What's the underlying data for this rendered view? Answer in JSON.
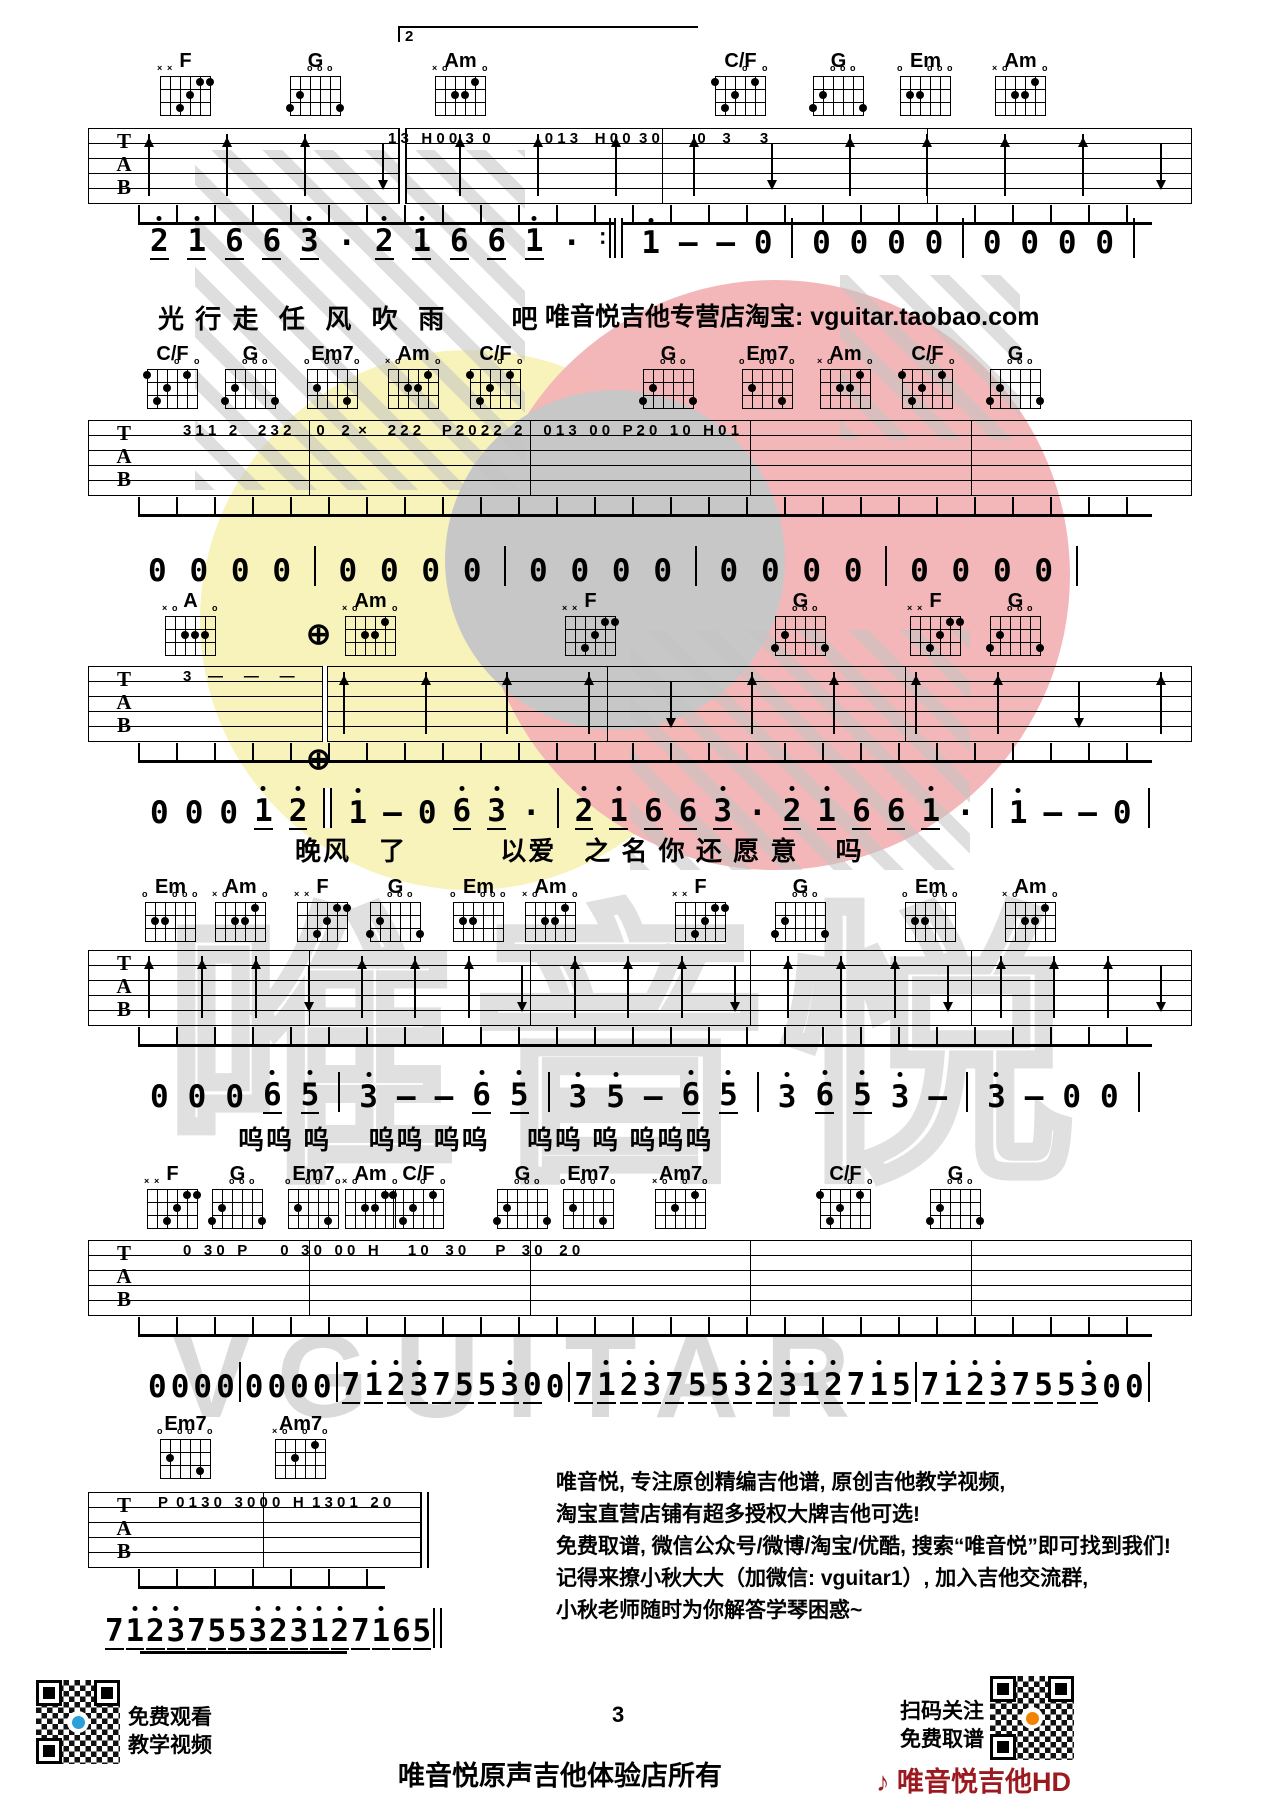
{
  "page_number": "3",
  "store_line": "唯音悦吉他专营店淘宝: vguitar.taobao.com",
  "footer_owner": "唯音悦原声吉他体验店所有",
  "brand_red": "♪ 唯音悦吉他HD",
  "qr_left": [
    "免费观看",
    "教学视频"
  ],
  "qr_right": [
    "扫码关注",
    "免费取谱"
  ],
  "promo": [
    "唯音悦, 专注原创精编吉他谱, 原创吉他教学视频,",
    "淘宝直营店铺有超多授权大牌吉他可选!",
    "免费取谱, 微信公众号/微博/淘宝/优酷, 搜索“唯音悦”即可找到我们!",
    "记得来撩小秋大大（加微信: vguitar1）, 加入吉他交流群,",
    "小秋老师随时为你解答学琴困惑~"
  ],
  "watermark": {
    "text_cn": "唯音悦",
    "text_en": "VGUITAR",
    "yellow": "#f7f3bb",
    "red": "#f3b3b5",
    "gray": "#c7c7c7"
  },
  "chord_shapes": {
    "F": {
      "m": [
        "x",
        "x",
        "",
        "",
        "",
        ""
      ],
      "d": [
        [
          4,
          3
        ],
        [
          3,
          2
        ],
        [
          2,
          1
        ],
        [
          1,
          1
        ]
      ]
    },
    "G": {
      "m": [
        "",
        "",
        "o",
        "o",
        "o",
        ""
      ],
      "d": [
        [
          6,
          3
        ],
        [
          5,
          2
        ],
        [
          1,
          3
        ]
      ]
    },
    "Am": {
      "m": [
        "x",
        "o",
        "",
        "",
        "",
        "o"
      ],
      "d": [
        [
          2,
          1
        ],
        [
          4,
          2
        ],
        [
          3,
          2
        ]
      ]
    },
    "C/F": {
      "m": [
        "",
        "",
        "",
        "o",
        "",
        "o"
      ],
      "d": [
        [
          6,
          1
        ],
        [
          2,
          1
        ],
        [
          4,
          2
        ],
        [
          5,
          3
        ]
      ]
    },
    "Em": {
      "m": [
        "o",
        "",
        "",
        "o",
        "o",
        "o"
      ],
      "d": [
        [
          5,
          2
        ],
        [
          4,
          2
        ]
      ]
    },
    "Em7": {
      "m": [
        "o",
        "",
        "o",
        "o",
        "",
        "o"
      ],
      "d": [
        [
          5,
          2
        ],
        [
          2,
          3
        ]
      ]
    },
    "Am7": {
      "m": [
        "x",
        "o",
        "",
        "o",
        "",
        "o"
      ],
      "d": [
        [
          4,
          2
        ],
        [
          2,
          1
        ]
      ]
    },
    "A": {
      "m": [
        "x",
        "o",
        "",
        "",
        "",
        "o"
      ],
      "d": [
        [
          4,
          2
        ],
        [
          3,
          2
        ],
        [
          2,
          2
        ]
      ]
    }
  },
  "systems": [
    {
      "cy": 50,
      "chords": [
        {
          "n": "F",
          "x": 185
        },
        {
          "n": "G",
          "x": 315
        },
        {
          "n": "Am",
          "x": 460
        },
        {
          "n": "C/F",
          "x": 740
        },
        {
          "n": "G",
          "x": 838
        },
        {
          "n": "Em",
          "x": 925
        },
        {
          "n": "Am",
          "x": 1020
        }
      ],
      "staff": {
        "x1": 88,
        "x2": 1192,
        "y": 128,
        "fracs": [
          0.281,
          0.52,
          0.76
        ],
        "rep0": "thick",
        "ann": "1 3   H 0 0  3  0             0 1 3    H 0 0  3 0         0    3       3",
        "annx": 300,
        "strums": "uuuduuuuduuuud",
        "strum_l": 60,
        "strum_r": 30
      },
      "volta": {
        "x": 398,
        "y": 26,
        "w": 298,
        "label": "2"
      },
      "numbers": {
        "y": 218,
        "x1": 150,
        "x2": 1135,
        "toks": [
          "'_2",
          "'_1",
          "_6",
          "_6",
          "'_3",
          "·",
          "'_2",
          "'_1",
          "_6",
          "_6",
          "'_1",
          "·",
          ":‖",
          "'1",
          "—",
          "—",
          "0",
          "|",
          "0",
          "0",
          "0",
          "0",
          "|",
          "0",
          "0",
          "0",
          "0",
          "|"
        ]
      },
      "lyrics": {
        "x": 158,
        "y": 299,
        "text": "光 行 走  任  风  吹  雨　　 吧"
      }
    },
    {
      "cy": 343,
      "chords": [
        {
          "n": "C/F",
          "x": 172
        },
        {
          "n": "G",
          "x": 250
        },
        {
          "n": "Em7",
          "x": 332
        },
        {
          "n": "Am",
          "x": 413
        },
        {
          "n": "C/F",
          "x": 495
        },
        {
          "n": "G",
          "x": 668
        },
        {
          "n": "Em7",
          "x": 767
        },
        {
          "n": "Am",
          "x": 845
        },
        {
          "n": "C/F",
          "x": 927
        },
        {
          "n": "G",
          "x": 1015
        }
      ],
      "staff": {
        "x1": 88,
        "x2": 1192,
        "y": 420,
        "fracs": [
          0.2,
          0.4,
          0.6,
          0.8
        ],
        "ann": "3 1 1   2     2 3 2      0    2  ×     2 2 2     P 2 0 2 2   2     0 1 3   0 0   P 2 0   1 0   H 0 1",
        "annx": 95,
        "strums": ""
      },
      "numbers": {
        "y": 546,
        "x1": 148,
        "x2": 1078,
        "toks": [
          "0",
          "0",
          "0",
          "0",
          "|",
          "0",
          "0",
          "0",
          "0",
          "|",
          "0",
          "0",
          "0",
          "0",
          "|",
          "0",
          "0",
          "0",
          "0",
          "|",
          "0",
          "0",
          "0",
          "0",
          "|"
        ]
      }
    },
    {
      "cy": 590,
      "chords": [
        {
          "n": "A",
          "x": 190
        },
        {
          "n": "Am",
          "x": 370
        },
        {
          "n": "F",
          "x": 590
        },
        {
          "n": "G",
          "x": 800
        },
        {
          "n": "F",
          "x": 935
        },
        {
          "n": "G",
          "x": 1015
        }
      ],
      "staff": {
        "x1": 88,
        "x2": 1192,
        "y": 666,
        "fracs": [
          0.212,
          0.47,
          0.74
        ],
        "rep0": "dbl",
        "ann": "3    —     —     —",
        "annx": 95,
        "strums": "uuuuduuuudu",
        "strum_l": 255,
        "strum_r": 30
      },
      "marks": [
        {
          "t": "⊕",
          "x": 306,
          "y": 620
        },
        {
          "t": "⊕",
          "x": 306,
          "y": 745
        }
      ],
      "numbers": {
        "y": 788,
        "x1": 150,
        "x2": 1150,
        "toks": [
          "0",
          "0",
          "0",
          "'_1",
          "'_2",
          "‖",
          "'1",
          "—",
          "0",
          "'_6",
          "'_3",
          "·",
          "|",
          "'_2",
          "'_1",
          "_6",
          "_6",
          "'_3",
          "·",
          "'_2",
          "'_1",
          "_6",
          "_6",
          "'_1",
          "·",
          "|",
          "'1",
          "—",
          "—",
          "0",
          "|"
        ]
      },
      "lyrics": {
        "x": 295,
        "y": 831,
        "text": "晚风　了　　　 以爱　之 名 你 还 愿 意　 吗"
      }
    },
    {
      "cy": 876,
      "chords": [
        {
          "n": "Em",
          "x": 170
        },
        {
          "n": "Am",
          "x": 240
        },
        {
          "n": "F",
          "x": 322
        },
        {
          "n": "G",
          "x": 395
        },
        {
          "n": "Em",
          "x": 478
        },
        {
          "n": "Am",
          "x": 550
        },
        {
          "n": "F",
          "x": 700
        },
        {
          "n": "G",
          "x": 800
        },
        {
          "n": "Em",
          "x": 930
        },
        {
          "n": "Am",
          "x": 1030
        }
      ],
      "staff": {
        "x1": 88,
        "x2": 1192,
        "y": 950,
        "fracs": [
          0.2,
          0.4,
          0.6,
          0.8
        ],
        "ann": "",
        "annx": 95,
        "strums": "uuuduuuduuuduuuduuud",
        "strum_l": 60,
        "strum_r": 30
      },
      "numbers": {
        "y": 1072,
        "x1": 150,
        "x2": 1140,
        "toks": [
          "0",
          "0",
          "0",
          "'_6",
          "'_5",
          "|",
          "'3",
          "—",
          "—",
          "'_6",
          "'_5",
          "|",
          "'3",
          "'5",
          "—",
          "'_6",
          "'_5",
          "|",
          "'3",
          "'_6",
          "'_5",
          "'3",
          "—",
          "|",
          "'3",
          "—",
          "0",
          "0",
          "|"
        ]
      },
      "lyrics": {
        "x": 238,
        "y": 1120,
        "text": "呜呜 呜　 呜呜 呜呜　 呜呜 呜 呜呜呜"
      }
    },
    {
      "cy": 1163,
      "chords": [
        {
          "n": "F",
          "x": 172
        },
        {
          "n": "G",
          "x": 237
        },
        {
          "n": "Em7",
          "x": 313
        },
        {
          "n": "Am",
          "x": 370
        },
        {
          "n": "C/F",
          "x": 418
        },
        {
          "n": "G",
          "x": 522
        },
        {
          "n": "Em7",
          "x": 588
        },
        {
          "n": "Am7",
          "x": 680
        },
        {
          "n": "C/F",
          "x": 845
        },
        {
          "n": "G",
          "x": 955
        }
      ],
      "staff": {
        "x1": 88,
        "x2": 1192,
        "y": 1240,
        "fracs": [
          0.2,
          0.4,
          0.6,
          0.8
        ],
        "ann": "0   3 0   P        0   3 0   0 0   H       1 0    3 0       P    3 0    2 0",
        "annx": 95,
        "strums": ""
      },
      "numbers": {
        "y": 1362,
        "x1": 148,
        "x2": 1150,
        "toks": [
          "0",
          "0",
          "0",
          "0",
          "|",
          "0",
          "0",
          "0",
          "0",
          "|",
          "_7",
          "'_1",
          "'_2",
          "'_3",
          "_7",
          "_5",
          "_5",
          "'_3",
          "_0",
          "0",
          "|",
          "_7",
          "'_1",
          "'_2",
          "'_3",
          "_7",
          "_5",
          "_5",
          "'_3",
          "'_2",
          "'_3",
          "'_1",
          "'_2",
          "_7",
          "'_1",
          "_5",
          "|",
          "_7",
          "'_1",
          "'_2",
          "'_3",
          "_7",
          "_5",
          "_5",
          "'_3",
          "0",
          "0",
          "|"
        ]
      }
    },
    {
      "cy": 1413,
      "chords": [
        {
          "n": "Em7",
          "x": 185
        },
        {
          "n": "Am7",
          "x": 300
        }
      ],
      "staff": {
        "x1": 88,
        "x2": 425,
        "y": 1492,
        "fracs": [
          0.52
        ],
        "end": "thick",
        "ann": "P  0 1 3 0   3 0 0 0   H  1 3 0 1   2 0",
        "annx": 70,
        "strums": ""
      },
      "rules": [
        {
          "x": 140,
          "y": 1651,
          "w": 207,
          "h": 3
        }
      ],
      "numbers": {
        "y": 1608,
        "x1": 105,
        "x2": 442,
        "toks": [
          "_7",
          "'_1",
          "'_2",
          "'_3",
          "_7",
          "_5",
          "_5",
          "'_3",
          "'_2",
          "'_3",
          "'_1",
          "'_2",
          "_7",
          "'_1",
          "_6",
          "_5",
          "‖"
        ]
      }
    }
  ]
}
